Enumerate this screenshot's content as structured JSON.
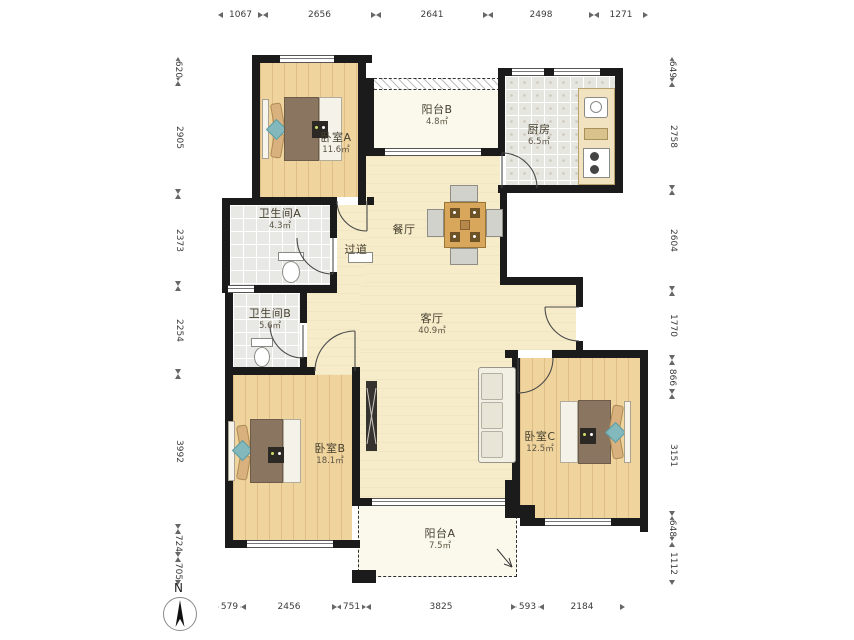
{
  "compass": {
    "label": "N",
    "icon": "north-arrow"
  },
  "rooms": [
    {
      "name": "卧室A",
      "area": "11.6㎡"
    },
    {
      "name": "阳台B",
      "area": "4.8㎡"
    },
    {
      "name": "厨房",
      "area": "6.5㎡"
    },
    {
      "name": "卫生间A",
      "area": "4.3㎡"
    },
    {
      "name": "过道",
      "area": ""
    },
    {
      "name": "餐厅",
      "area": ""
    },
    {
      "name": "客厅",
      "area": "40.9㎡"
    },
    {
      "name": "卫生间B",
      "area": "5.6㎡"
    },
    {
      "name": "卧室B",
      "area": "18.1㎡"
    },
    {
      "name": "卧室C",
      "area": "12.5㎡"
    },
    {
      "name": "阳台A",
      "area": "7.5㎡"
    }
  ],
  "dimensions": {
    "top": [
      "1067",
      "2656",
      "2641",
      "2498",
      "1271"
    ],
    "bottom": [
      "579",
      "2456",
      "751",
      "3825",
      "593",
      "2184"
    ],
    "left": [
      "620",
      "2905",
      "2373",
      "2254",
      "3992",
      "724",
      "705"
    ],
    "right": [
      "649",
      "2758",
      "2604",
      "1770",
      "866",
      "3151",
      "648",
      "1112"
    ]
  },
  "colors": {
    "wall": "#1b1b1b",
    "bedroom_floor": "#f0d49e",
    "living_floor": "#f6ecca",
    "balcony_floor": "#fbf9ec",
    "tile_floor": "#e8e8e4",
    "accent_teal": "#83b9bd",
    "blanket_brown": "#8a7561"
  }
}
